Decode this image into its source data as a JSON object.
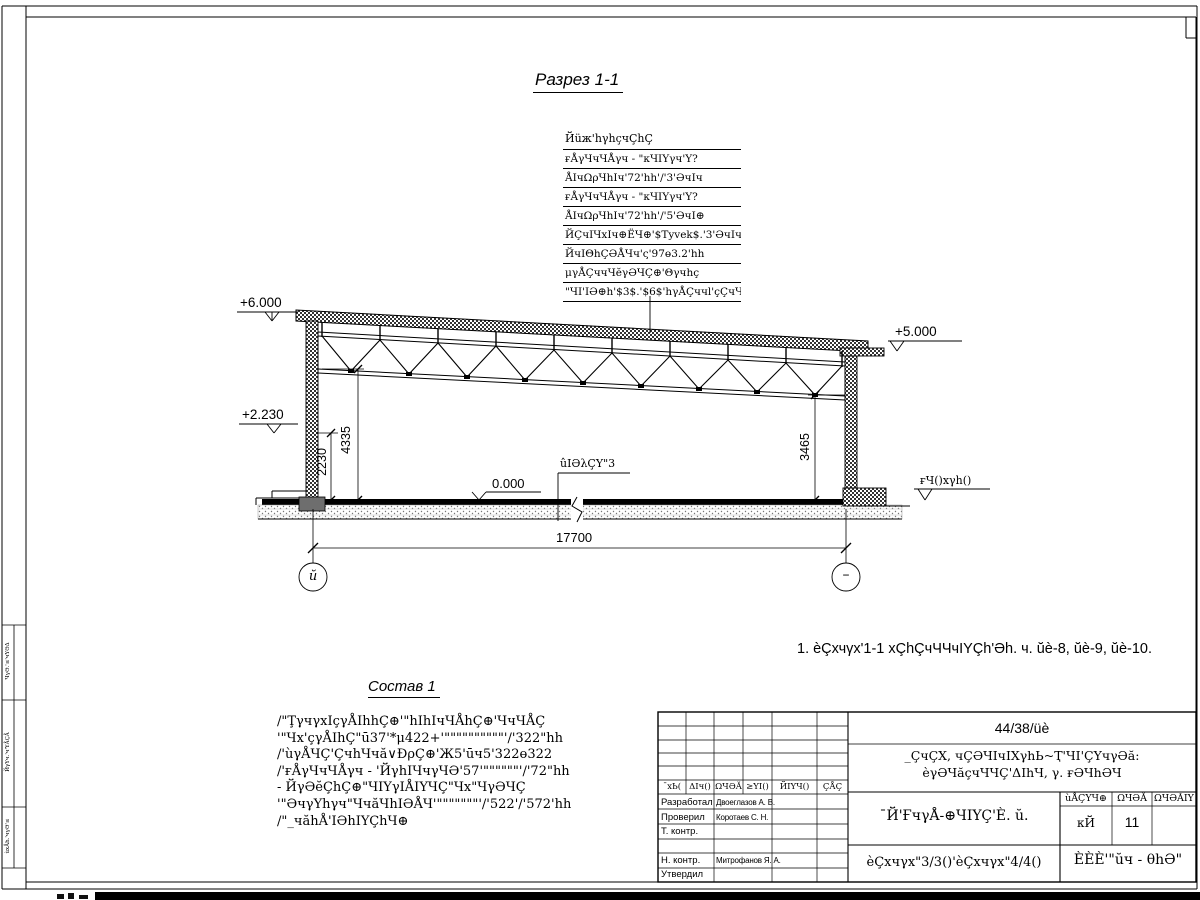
{
  "drawing": {
    "section_title": "Разрез 1-1",
    "note": "1. ѐÇхчγх'1-1 хÇhÇчЧЧчIYÇh'Әh. ч. ŭѐ-8, ŭѐ-9, ŭѐ-10.",
    "floor_label": "ûIӘλÇY\"3",
    "ground_label": "ғЧ()хγh()"
  },
  "roof_callout": {
    "header": "Йüж'hγhçчÇhÇ",
    "rows": [
      "ғÅγЧчЧÅγч - \"кЧIYγч'Y?372'Чγ|h5.",
      "ÅIчΩρЧhIч'72'hh'/'3'ӘчIч",
      "ғÅγЧчЧÅγч - \"кЧIYγч'Y?322'Чγ|h5.",
      "ÅIчΩρЧhIч'72'hh'/'5'ӘчI⊕",
      "ЙÇчIЧхIч⊕ЁЧ⊕'$Tyvek$.'3'ӘчIч",
      "ЙчIΘhÇӘÅЧч'ς'97ө3.2'hh",
      "μγÅÇччЧĕγӘЧÇ⊕'Θγчhç",
      "\"ЧI'IӘ⊕h'$3$.'$6$'hγÅÇччl'çÇчЧЧ+"
    ]
  },
  "elevations": {
    "top_left": "+6.000",
    "mid_left": "+2.230",
    "top_right": "+5.000",
    "floor": "0.000"
  },
  "dims": {
    "width": "17700",
    "h1": "2230",
    "h2": "4335",
    "h3": "3465"
  },
  "axes": {
    "left": "ŭ",
    "right": "–"
  },
  "sostav": {
    "title": "Состав 1",
    "lines": [
      "/\"ŢγчγхIçγÅIhhÇ⊕'\"hIhIчЧÅhÇ⊕'ЧчЧÅÇ",
      "'\"Чх'çγÅIhÇ\"ū37'*μ422+'\"\"\"\"\"\"\"\"\"\"'/'322\"hh",
      "/'ùγÅЧÇ'ÇчhЧчă∨ĐρÇ⊕'Ж5'ūч5'322ө322",
      "/'ғÅγЧчЧÅγч - 'ЙγhIЧчγЧӘ'57'\"\"\"\"\"\"'/'72\"hh",
      "- ЙγӘĕÇhÇ⊕\"ЧIYγIÅIYЧÇ\"Чх\"ЧγӘЧÇ",
      "'\"ӘчγYhγч\"ЧчăЧhIӘÅЧ'\"\"\"\"\"\"\"'/'522'/'572'hh",
      "/\"_чăhÅ'IӘhIYÇhЧ⊕"
    ]
  },
  "title_block": {
    "doc_number": "44/38/üѐ",
    "object_line1": "_ÇчÇХ, чÇӘЧIчIХγhЬ~Ҭ'ЧI'ÇYчγӘă:",
    "object_line2": "ѐγӘЧăçчЧЧÇ'ΔIhЧ, γ. ғӘЧhӘЧ",
    "sheet_title": "¯Й'ҒчγÅ-⊕ЧIYÇ'È. ŭ.",
    "header_cols": [
      "¯хЬ(",
      "ΔIч()",
      "ΩЧӘĂ",
      "≥YI()",
      "ЙIYЧ()",
      "ÇÅÇ"
    ],
    "rows": [
      {
        "role": "Разработал",
        "name": "Двоеглазов А. В."
      },
      {
        "role": "Проверил",
        "name": "Коротаев С. Н."
      },
      {
        "role": "Т. контр.",
        "name": ""
      },
      {
        "role": "",
        "name": ""
      },
      {
        "role": "Н. контр.",
        "name": "Митрофанов Я. А."
      },
      {
        "role": "Утвердил",
        "name": ""
      }
    ],
    "stage_header": [
      "ùÅÇYЧ⊕",
      "ΩЧӘĂ",
      "ΩЧӘĂIY"
    ],
    "stage": "кЙ",
    "sheet_num": "11",
    "sheets_total": "",
    "bottom_center": "ѐÇхчγх\"3/3()'ѐÇхчγх\"4/4()",
    "bottom_right": "ÈÈÈ'\"ŭч - θhӘ\""
  },
  "side_strip": {
    "cell1": "ЧγӘ.'≤'чYӘΔ",
    "cell2": "ЙγYч.'ч'YÅÇÅ",
    "cell3": "ùхÅh.'чγӘ'≤"
  }
}
